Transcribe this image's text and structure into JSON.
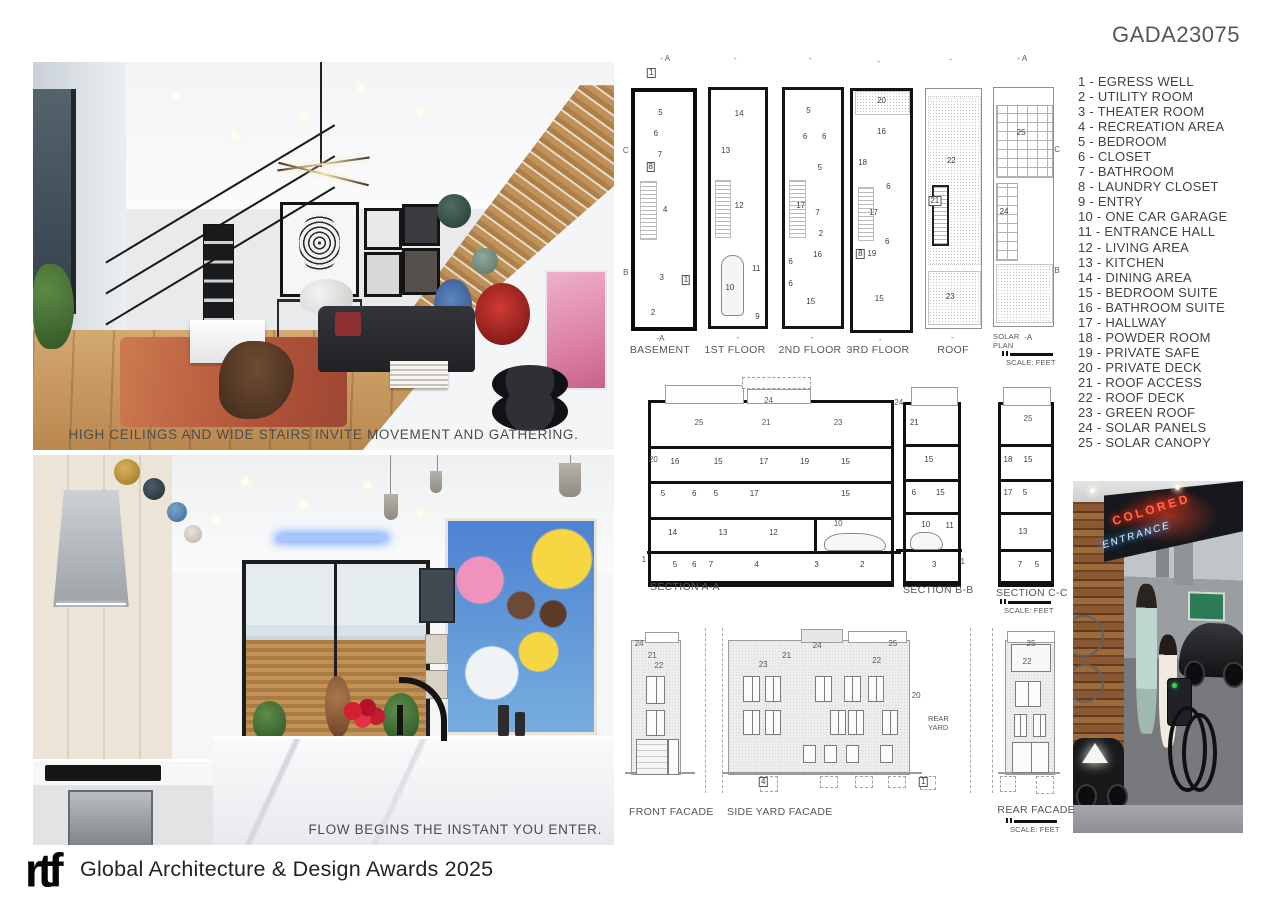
{
  "board": {
    "code": "GADA23075"
  },
  "footer": {
    "logo": "rtf",
    "text": "Global Architecture & Design Awards 2025"
  },
  "photos": {
    "hall": {
      "caption": "HIGH CEILINGS AND WIDE STAIRS INVITE MOVEMENT AND GATHERING."
    },
    "kitchen": {
      "caption": "FLOW BEGINS THE INSTANT YOU ENTER."
    },
    "garage": {
      "neon_top": "COLORED",
      "neon_bottom": "ENTRANCE"
    }
  },
  "legend": {
    "items": [
      {
        "text": "1 - EGRESS  WELL"
      },
      {
        "text": "2 - UTILITY  ROOM"
      },
      {
        "text": "3 - THEATER  ROOM"
      },
      {
        "text": "4 - RECREATION  AREA"
      },
      {
        "text": "5 - BEDROOM"
      },
      {
        "text": "6 - CLOSET"
      },
      {
        "text": "7 - BATHROOM"
      },
      {
        "text": "8 - LAUNDRY  CLOSET"
      },
      {
        "text": "9 - ENTRY"
      },
      {
        "text": "10 - ONE CAR GARAGE"
      },
      {
        "text": "11 - ENTRANCE  HALL"
      },
      {
        "text": "12 - LIVING  AREA"
      },
      {
        "text": "13 - KITCHEN"
      },
      {
        "text": "14 - DINING  AREA"
      },
      {
        "text": "15 - BEDROOM  SUITE"
      },
      {
        "text": "16 - BATHROOM  SUITE"
      },
      {
        "text": "17 - HALLWAY"
      },
      {
        "text": "18 - POWDER  ROOM"
      },
      {
        "text": "19 - PRIVATE SAFE"
      },
      {
        "text": "20 - PRIVATE DECK"
      },
      {
        "text": "21 - ROOF ACCESS"
      },
      {
        "text": "22 - ROOF DECK"
      },
      {
        "text": "23 - GREEN  ROOF"
      },
      {
        "text": "24 - SOLAR  PANELS"
      },
      {
        "text": "25 - SOLAR  CANOPY"
      }
    ]
  },
  "drawings": {
    "scale_label": "SCALE: FEET",
    "rear_yard": "REAR YARD",
    "solar_plan_label": "SOLAR PLAN",
    "plans": [
      {
        "label": "BASEMENT",
        "numbers": [
          {
            "n": "5",
            "x": 44,
            "y": 9
          },
          {
            "n": "6",
            "x": 36,
            "y": 18
          },
          {
            "n": "7",
            "x": 43,
            "y": 27
          },
          {
            "n": "8",
            "x": 27,
            "y": 32,
            "cls": "bx"
          },
          {
            "n": "4",
            "x": 52,
            "y": 50
          },
          {
            "n": "3",
            "x": 46,
            "y": 79
          },
          {
            "n": "2",
            "x": 31,
            "y": 94
          },
          {
            "n": "1",
            "x": 88,
            "y": 80,
            "cls": "bx"
          },
          {
            "n": "1",
            "x": 28,
            "y": -8,
            "cls": "bx"
          },
          {
            "n": "- A",
            "x": 52,
            "y": -14,
            "cls": "mk"
          },
          {
            "n": "C",
            "x": -16,
            "y": 25,
            "cls": "mk"
          },
          {
            "n": "B",
            "x": -16,
            "y": 77,
            "cls": "mk"
          },
          {
            "n": "-A",
            "x": 44,
            "y": 105,
            "cls": "mk"
          }
        ]
      },
      {
        "label": "1ST  FLOOR",
        "numbers": [
          {
            "n": "14",
            "x": 52,
            "y": 10
          },
          {
            "n": "13",
            "x": 27,
            "y": 26
          },
          {
            "n": "12",
            "x": 52,
            "y": 49
          },
          {
            "n": "10",
            "x": 35,
            "y": 84
          },
          {
            "n": "11",
            "x": 84,
            "y": 76
          },
          {
            "n": "9",
            "x": 86,
            "y": 96
          },
          {
            "n": "-",
            "x": 45,
            "y": -13,
            "cls": "mk"
          },
          {
            "n": "-",
            "x": 50,
            "y": 105,
            "cls": "mk"
          }
        ]
      },
      {
        "label": "2ND FLOOR",
        "numbers": [
          {
            "n": "5",
            "x": 42,
            "y": 9
          },
          {
            "n": "6",
            "x": 36,
            "y": 20
          },
          {
            "n": "6",
            "x": 70,
            "y": 20
          },
          {
            "n": "5",
            "x": 62,
            "y": 33
          },
          {
            "n": "17",
            "x": 28,
            "y": 49
          },
          {
            "n": "7",
            "x": 58,
            "y": 52
          },
          {
            "n": "2",
            "x": 64,
            "y": 61
          },
          {
            "n": "16",
            "x": 58,
            "y": 70
          },
          {
            "n": "6",
            "x": 10,
            "y": 73
          },
          {
            "n": "6",
            "x": 10,
            "y": 82
          },
          {
            "n": "15",
            "x": 46,
            "y": 90
          },
          {
            "n": "-",
            "x": 45,
            "y": -13,
            "cls": "mk"
          },
          {
            "n": "-",
            "x": 48,
            "y": 105,
            "cls": "mk"
          }
        ]
      },
      {
        "label": "3RD FLOOR",
        "numbers": [
          {
            "n": "20",
            "x": 50,
            "y": 4
          },
          {
            "n": "16",
            "x": 50,
            "y": 17
          },
          {
            "n": "18",
            "x": 17,
            "y": 30
          },
          {
            "n": "6",
            "x": 62,
            "y": 40
          },
          {
            "n": "17",
            "x": 36,
            "y": 51
          },
          {
            "n": "6",
            "x": 60,
            "y": 63
          },
          {
            "n": "8",
            "x": 13,
            "y": 68,
            "cls": "bx"
          },
          {
            "n": "19",
            "x": 33,
            "y": 68
          },
          {
            "n": "15",
            "x": 46,
            "y": 87
          },
          {
            "n": "-",
            "x": 45,
            "y": -12,
            "cls": "mk"
          },
          {
            "n": "-",
            "x": 48,
            "y": 104,
            "cls": "mk"
          }
        ]
      },
      {
        "label": "ROOF",
        "numbers": [
          {
            "n": "22",
            "x": 46,
            "y": 30
          },
          {
            "n": "21",
            "x": 16,
            "y": 47,
            "cls": "bx"
          },
          {
            "n": "23",
            "x": 44,
            "y": 87
          },
          {
            "n": "-",
            "x": 45,
            "y": -12,
            "cls": "mk"
          },
          {
            "n": "-",
            "x": 48,
            "y": 104,
            "cls": "mk"
          }
        ]
      },
      {
        "label": "",
        "numbers": [
          {
            "n": "25",
            "x": 46,
            "y": 19
          },
          {
            "n": "24",
            "x": 17,
            "y": 52
          },
          {
            "n": "- A",
            "x": 48,
            "y": -12,
            "cls": "mk"
          },
          {
            "n": "C",
            "x": 107,
            "y": 26,
            "cls": "mk"
          },
          {
            "n": "B",
            "x": 107,
            "y": 77,
            "cls": "mk"
          },
          {
            "n": "-A",
            "x": 58,
            "y": 105,
            "cls": "mk"
          }
        ]
      }
    ],
    "sections": [
      {
        "label": "SECTION  A-A",
        "numbers": [
          {
            "n": "24",
            "x": 49,
            "y": -1,
            "cls": "mk"
          },
          {
            "n": "25",
            "x": 20,
            "y": 11,
            "cls": "mk"
          },
          {
            "n": "21",
            "x": 48,
            "y": 11,
            "cls": "mk"
          },
          {
            "n": "23",
            "x": 78,
            "y": 11,
            "cls": "mk"
          },
          {
            "n": "20",
            "x": 1,
            "y": 32,
            "cls": "mk"
          },
          {
            "n": "16",
            "x": 10,
            "y": 33
          },
          {
            "n": "15",
            "x": 28,
            "y": 33
          },
          {
            "n": "17",
            "x": 47,
            "y": 33
          },
          {
            "n": "19",
            "x": 64,
            "y": 33
          },
          {
            "n": "15",
            "x": 81,
            "y": 33
          },
          {
            "n": "5",
            "x": 5,
            "y": 51
          },
          {
            "n": "6",
            "x": 18,
            "y": 51
          },
          {
            "n": "5",
            "x": 27,
            "y": 51
          },
          {
            "n": "17",
            "x": 43,
            "y": 51
          },
          {
            "n": "15",
            "x": 81,
            "y": 51
          },
          {
            "n": "14",
            "x": 9,
            "y": 73
          },
          {
            "n": "13",
            "x": 30,
            "y": 73
          },
          {
            "n": "12",
            "x": 51,
            "y": 73
          },
          {
            "n": "10",
            "x": 78,
            "y": 68,
            "cls": "mk"
          },
          {
            "n": "1",
            "x": -3,
            "y": 88,
            "cls": "mk"
          },
          {
            "n": "5",
            "x": 10,
            "y": 91
          },
          {
            "n": "6",
            "x": 18,
            "y": 91
          },
          {
            "n": "7",
            "x": 25,
            "y": 91
          },
          {
            "n": "4",
            "x": 44,
            "y": 91
          },
          {
            "n": "3",
            "x": 69,
            "y": 91
          },
          {
            "n": "2",
            "x": 88,
            "y": 91
          }
        ]
      },
      {
        "label": "SECTION  B-B",
        "numbers": [
          {
            "n": "24",
            "x": -14,
            "y": -1,
            "cls": "mk"
          },
          {
            "n": "21",
            "x": 16,
            "y": 10
          },
          {
            "n": "15",
            "x": 44,
            "y": 31
          },
          {
            "n": "6",
            "x": 15,
            "y": 50
          },
          {
            "n": "15",
            "x": 66,
            "y": 50
          },
          {
            "n": "10",
            "x": 38,
            "y": 68
          },
          {
            "n": "11",
            "x": 84,
            "y": 69
          },
          {
            "n": "3",
            "x": 54,
            "y": 91
          },
          {
            "n": "1",
            "x": 109,
            "y": 89,
            "cls": "mk"
          }
        ]
      },
      {
        "label": "SECTION  C-C",
        "numbers": [
          {
            "n": "25",
            "x": 54,
            "y": 8,
            "cls": "mk"
          },
          {
            "n": "18",
            "x": 14,
            "y": 31
          },
          {
            "n": "15",
            "x": 54,
            "y": 31
          },
          {
            "n": "17",
            "x": 14,
            "y": 50
          },
          {
            "n": "5",
            "x": 48,
            "y": 50
          },
          {
            "n": "13",
            "x": 44,
            "y": 72
          },
          {
            "n": "7",
            "x": 38,
            "y": 91
          },
          {
            "n": "5",
            "x": 72,
            "y": 91
          }
        ]
      }
    ],
    "facades": [
      {
        "label": "FRONT FACADE",
        "numbers": [
          {
            "n": "24",
            "x": 15,
            "y": 2,
            "cls": "mk"
          },
          {
            "n": "21",
            "x": 42,
            "y": 11,
            "cls": "mk"
          },
          {
            "n": "22",
            "x": 56,
            "y": 19,
            "cls": "mk"
          }
        ]
      },
      {
        "label": "SIDE YARD FACADE",
        "numbers": [
          {
            "n": "23",
            "x": 19,
            "y": 18,
            "cls": "mk"
          },
          {
            "n": "21",
            "x": 32,
            "y": 11,
            "cls": "mk"
          },
          {
            "n": "24",
            "x": 49,
            "y": 4,
            "cls": "mk"
          },
          {
            "n": "25",
            "x": 91,
            "y": 2,
            "cls": "mk"
          },
          {
            "n": "22",
            "x": 82,
            "y": 15,
            "cls": "mk"
          },
          {
            "n": "20",
            "x": 104,
            "y": 41,
            "cls": "mk"
          },
          {
            "n": "4",
            "x": 19,
            "y": 106,
            "cls": "bx"
          },
          {
            "n": "1",
            "x": 108,
            "y": 106,
            "cls": "bx"
          }
        ]
      },
      {
        "label": "REAR FACADE",
        "numbers": [
          {
            "n": "25",
            "x": 52,
            "y": 2,
            "cls": "mk"
          },
          {
            "n": "22",
            "x": 44,
            "y": 16,
            "cls": "mk"
          }
        ]
      }
    ]
  }
}
